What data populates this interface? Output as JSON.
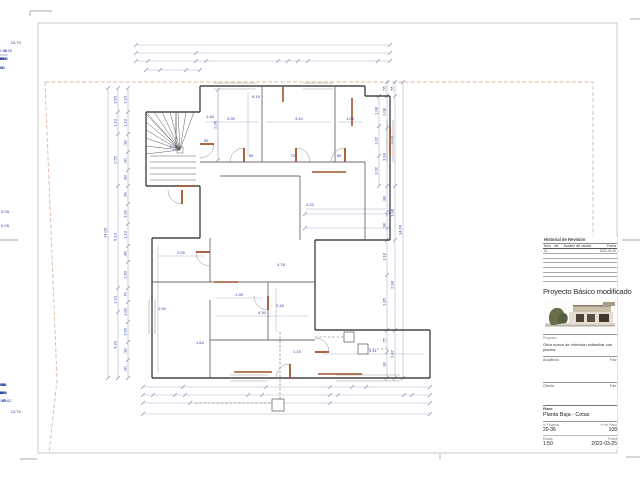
{
  "title_block": {
    "revision": {
      "title": "Historial de Revisión",
      "columns": [
        "Núm.",
        "Ind.",
        "Nombre del cambio",
        "Fecha"
      ],
      "rows": [
        [
          "01",
          "",
          "",
          "2022-03-25"
        ],
        [
          "",
          "",
          "",
          ""
        ],
        [
          "",
          "",
          "",
          ""
        ],
        [
          "",
          "",
          "",
          ""
        ],
        [
          "",
          "",
          "",
          ""
        ],
        [
          "",
          "",
          "",
          ""
        ],
        [
          "",
          "",
          "",
          ""
        ]
      ]
    },
    "project_title": "Proyecto Básico modificado",
    "project_label": "Proyecto:",
    "project_description": "Obra nueva de vivienda unifamiliar con piscina",
    "architect_label": "Arquitecto",
    "client_label": "Cliente",
    "signature_label": "Fdo:",
    "sheet_label": "Plano:",
    "sheet_name": "Planta Baja - Cotas",
    "project_no_label": "nº Proyecto",
    "project_no": "20-36",
    "plan_no_label": "nº de Plano",
    "plan_no": "108",
    "scale_label": "Escala",
    "scale": "1:50",
    "date_label": "Fecha",
    "date": "2022-03-25"
  },
  "colors": {
    "dim": "#aab2cf",
    "tick": "#8892bb",
    "dim_text": "#2b3e9e",
    "wall": "#474747",
    "interior": "#6b6b6b",
    "door": "#a0522d",
    "boundary": "#dcbaa4",
    "mark": "#a8a8a8",
    "border": "#c8c8c8",
    "window": "#9a9a9a",
    "utility": "#6a6a6a",
    "stair": "#5a5a5a"
  },
  "drawing": {
    "border": [
      38,
      23,
      579,
      430
    ],
    "marks": [
      [
        30,
        11,
        52,
        11
      ],
      [
        30,
        11,
        30,
        16
      ],
      [
        0,
        55,
        8,
        55
      ],
      [
        0,
        240,
        18,
        240
      ],
      [
        622,
        240,
        640,
        240
      ],
      [
        630,
        19,
        640,
        19
      ],
      [
        20,
        459,
        37,
        459
      ],
      [
        626,
        457,
        640,
        457
      ],
      [
        440,
        454,
        440,
        459
      ]
    ],
    "boundary": [
      "45,82 593,82 593,236",
      "45,82 57,380 49,453"
    ],
    "walls": [
      [
        200,
        86,
        365,
        86
      ],
      [
        365,
        86,
        365,
        96
      ],
      [
        365,
        96,
        390,
        96
      ],
      [
        390,
        96,
        390,
        240
      ],
      [
        390,
        240,
        315,
        240
      ],
      [
        315,
        240,
        315,
        330
      ],
      [
        315,
        330,
        430,
        330
      ],
      [
        430,
        330,
        430,
        378
      ],
      [
        430,
        378,
        152,
        378
      ],
      [
        152,
        378,
        152,
        238
      ],
      [
        152,
        238,
        200,
        238
      ],
      [
        200,
        238,
        200,
        186
      ],
      [
        200,
        186,
        146,
        186
      ],
      [
        146,
        186,
        146,
        112
      ],
      [
        146,
        112,
        200,
        112
      ],
      [
        200,
        112,
        200,
        86
      ]
    ],
    "interior": [
      [
        200,
        162,
        365,
        162
      ],
      [
        220,
        176,
        300,
        176
      ],
      [
        262,
        86,
        262,
        162
      ],
      [
        335,
        86,
        335,
        162
      ],
      [
        300,
        176,
        300,
        240
      ],
      [
        365,
        162,
        365,
        240
      ],
      [
        152,
        282,
        315,
        282
      ],
      [
        210,
        238,
        210,
        282
      ],
      [
        210,
        300,
        210,
        378
      ],
      [
        268,
        282,
        268,
        340
      ],
      [
        210,
        340,
        315,
        340
      ],
      [
        176,
        112,
        176,
        148
      ]
    ],
    "windows": [
      [
        214,
        83,
        256,
        83
      ],
      [
        214,
        89,
        256,
        89
      ],
      [
        303,
        83,
        333,
        83
      ],
      [
        303,
        89,
        333,
        89
      ],
      [
        387,
        120,
        387,
        162
      ],
      [
        393,
        120,
        393,
        162
      ],
      [
        149,
        300,
        149,
        334
      ],
      [
        155,
        300,
        155,
        334
      ],
      [
        230,
        375,
        268,
        375
      ],
      [
        230,
        381,
        268,
        381
      ],
      [
        336,
        375,
        400,
        375
      ],
      [
        336,
        381,
        400,
        381
      ]
    ],
    "orange": [
      [
        283,
        86,
        283,
        102
      ],
      [
        352,
        98,
        352,
        126
      ],
      [
        312,
        172,
        346,
        172
      ],
      [
        390,
        126,
        390,
        156
      ],
      [
        214,
        282,
        238,
        282
      ],
      [
        234,
        372,
        272,
        372
      ],
      [
        318,
        374,
        362,
        374
      ],
      [
        178,
        186,
        196,
        186
      ]
    ],
    "doors": [
      {
        "leaf": [
          244,
          162,
          244,
          148
        ],
        "arc": "M244,148 A14,14 0 0 0 230,162"
      },
      {
        "leaf": [
          296,
          162,
          296,
          148
        ],
        "arc": "M296,148 A14,14 0 0 1 310,162"
      },
      {
        "leaf": [
          345,
          162,
          345,
          148
        ],
        "arc": "M345,148 A14,14 0 0 0 331,162"
      },
      {
        "leaf": [
          200,
          144,
          214,
          144
        ],
        "arc": "M214,144 A14,14 0 0 1 200,158"
      },
      {
        "leaf": [
          210,
          252,
          196,
          252
        ],
        "arc": "M196,252 A14,14 0 0 0 210,266"
      },
      {
        "leaf": [
          268,
          296,
          268,
          310
        ],
        "arc": "M268,310 A14,14 0 0 1 254,296"
      },
      {
        "leaf": [
          290,
          378,
          290,
          364
        ],
        "arc": "M290,364 A14,14 0 0 0 276,378"
      },
      {
        "leaf": [
          315,
          352,
          329,
          352
        ],
        "arc": "M329,352 A14,14 0 0 0 315,338"
      },
      {
        "leaf": [
          182,
          190,
          182,
          204
        ],
        "arc": "M182,204 A14,14 0 0 1 168,190"
      }
    ],
    "stair": {
      "center": [
        180,
        150
      ],
      "targets": [
        [
          146,
          114
        ],
        [
          146,
          122
        ],
        [
          146,
          130
        ],
        [
          146,
          138
        ],
        [
          146,
          146
        ],
        [
          146,
          154
        ],
        [
          146,
          112
        ],
        [
          154,
          112
        ],
        [
          162,
          112
        ],
        [
          170,
          112
        ],
        [
          178,
          112
        ],
        [
          186,
          112
        ],
        [
          194,
          112
        ]
      ],
      "steps": [
        [
          150,
          156,
          196,
          156
        ],
        [
          150,
          162,
          196,
          162
        ],
        [
          150,
          168,
          196,
          168
        ],
        [
          150,
          174,
          196,
          174
        ],
        [
          150,
          180,
          196,
          180
        ]
      ]
    },
    "utility": {
      "dashes": [
        [
          280,
          332,
          280,
          401
        ],
        [
          195,
          403,
          274,
          403
        ],
        [
          315,
          337,
          344,
          337
        ],
        [
          368,
          349,
          388,
          349
        ]
      ],
      "squares": [
        [
          272,
          399,
          12,
          12
        ],
        [
          344,
          332,
          10,
          10
        ],
        [
          358,
          344,
          10,
          10
        ]
      ]
    },
    "aux": [
      [
        218,
        92,
        218,
        156
      ],
      [
        248,
        92,
        248,
        156
      ],
      [
        206,
        122,
        258,
        122
      ],
      [
        266,
        122,
        331,
        122
      ],
      [
        338,
        122,
        362,
        122
      ],
      [
        306,
        209,
        386,
        209
      ],
      [
        158,
        256,
        204,
        256
      ],
      [
        216,
        298,
        262,
        298
      ],
      [
        216,
        316,
        308,
        316
      ],
      [
        276,
        288,
        276,
        332
      ],
      [
        322,
        354,
        424,
        354
      ],
      [
        158,
        246,
        158,
        372
      ]
    ],
    "dims": [
      {
        "o": "h",
        "at": 45,
        "from": 136,
        "to": 390,
        "ticks": [
          136,
          390
        ],
        "labels": [
          [
            "15.73",
            268
          ]
        ]
      },
      {
        "o": "h",
        "at": 53,
        "from": 136,
        "to": 390,
        "ticks": [
          136,
          196,
          390
        ],
        "labels": [
          [
            "2.93",
            166
          ],
          [
            "8.20",
            296
          ]
        ]
      },
      {
        "o": "h",
        "at": 61,
        "from": 136,
        "to": 390,
        "ticks": [
          136,
          148,
          196,
          206,
          278,
          288,
          298,
          308,
          378,
          390
        ],
        "labels": [
          [
            ".90",
            142
          ],
          [
            "2.30",
            172
          ],
          [
            ".95",
            201
          ],
          [
            "3.10",
            242
          ],
          [
            ".75",
            283
          ],
          [
            ".80",
            293
          ],
          [
            ".73",
            303
          ],
          [
            "3.95",
            343
          ],
          [
            ".90",
            384
          ]
        ]
      },
      {
        "o": "h",
        "at": 70,
        "from": 146,
        "to": 200,
        "ticks": [
          146,
          160,
          186,
          200
        ],
        "labels": [
          [
            ".55",
            153
          ],
          [
            "1.40",
            173
          ],
          [
            ".55",
            193
          ]
        ]
      },
      {
        "o": "h",
        "at": 387,
        "from": 143,
        "to": 430,
        "ticks": [
          143,
          183,
          266,
          330,
          352,
          366,
          430
        ],
        "labels": [
          [
            "1.25",
            163
          ],
          [
            "2.20",
            224
          ],
          [
            "1.75",
            298
          ],
          [
            ".95",
            341
          ],
          [
            ".70",
            359
          ],
          [
            "2.60",
            398
          ]
        ]
      },
      {
        "o": "h",
        "at": 395,
        "from": 143,
        "to": 430,
        "ticks": [
          143,
          153,
          175,
          185,
          248,
          262,
          330,
          338,
          404,
          412,
          430
        ],
        "labels": [
          [
            ".35",
            148
          ],
          [
            ".80",
            164
          ],
          [
            ".35",
            180
          ],
          [
            "2.45",
            216
          ],
          [
            ".70",
            255
          ],
          [
            "2.90",
            296
          ],
          [
            ".25",
            334
          ],
          [
            "2.90",
            371
          ],
          [
            ".30",
            408
          ],
          [
            ".75",
            421
          ]
        ]
      },
      {
        "o": "h",
        "at": 403,
        "from": 143,
        "to": 430,
        "ticks": [
          143,
          190,
          330,
          430
        ],
        "labels": [
          [
            "1.55",
            166
          ],
          [
            "7.62",
            260
          ],
          [
            "2.40",
            380
          ]
        ]
      },
      {
        "o": "h",
        "at": 414,
        "from": 143,
        "to": 430,
        "ticks": [
          143,
          430
        ],
        "labels": [
          [
            "15.75",
            286
          ]
        ]
      },
      {
        "o": "v",
        "at": 108,
        "from": 88,
        "to": 378,
        "ticks": [
          88,
          378
        ],
        "labels": [
          [
            "14.00",
            233
          ]
        ]
      },
      {
        "o": "v",
        "at": 118,
        "from": 88,
        "to": 378,
        "ticks": [
          88,
          112,
          134,
          186,
          288,
          312,
          378
        ],
        "labels": [
          [
            "1.50",
            100
          ],
          [
            "1.10",
            123
          ],
          [
            "2.55",
            160
          ],
          [
            "5.10",
            237
          ],
          [
            "1.20",
            300
          ],
          [
            "3.30",
            345
          ]
        ]
      },
      {
        "o": "v",
        "at": 128,
        "from": 88,
        "to": 378,
        "ticks": [
          88,
          112,
          134,
          152,
          170,
          186,
          204,
          224,
          246,
          262,
          288,
          302,
          322,
          342,
          360,
          378
        ],
        "labels": [
          [
            "1.20",
            100
          ],
          [
            "1.10",
            123
          ],
          [
            ".90",
            143
          ],
          [
            ".90",
            161
          ],
          [
            ".80",
            178
          ],
          [
            ".90",
            195
          ],
          [
            "1.00",
            214
          ],
          [
            "1.10",
            235
          ],
          [
            ".80",
            254
          ],
          [
            "1.30",
            275
          ],
          [
            ".70",
            295
          ],
          [
            "1.00",
            312
          ],
          [
            "1.00",
            332
          ],
          [
            ".90",
            351
          ],
          [
            ".90",
            369
          ]
        ]
      },
      {
        "o": "v",
        "at": 403,
        "from": 82,
        "to": 378,
        "ticks": [
          82,
          378
        ],
        "labels": [
          [
            "14.60",
            230
          ]
        ]
      },
      {
        "o": "v",
        "at": 395,
        "from": 82,
        "to": 378,
        "ticks": [
          82,
          96,
          186,
          240,
          330,
          378
        ],
        "labels": [
          [
            ".55",
            89
          ],
          [
            "3.03",
            140
          ],
          [
            "1.98",
            213
          ],
          [
            "2.98",
            285
          ],
          [
            "1.47",
            354
          ]
        ]
      },
      {
        "o": "v",
        "at": 387,
        "from": 82,
        "to": 378,
        "ticks": [
          82,
          96,
          128,
          186,
          212,
          240,
          275,
          330,
          352,
          378
        ],
        "labels": [
          [
            ".55",
            89
          ],
          [
            "1.08",
            112
          ],
          [
            "1.93",
            157
          ],
          [
            ".88",
            199
          ],
          [
            ".98",
            226
          ],
          [
            "1.18",
            257
          ],
          [
            "1.85",
            302
          ],
          [
            ".75",
            341
          ],
          [
            ".90",
            365
          ]
        ]
      },
      {
        "o": "v",
        "at": 379,
        "from": 96,
        "to": 186,
        "ticks": [
          96,
          126,
          156,
          186
        ],
        "labels": [
          [
            "1.08",
            111
          ],
          [
            "1.02",
            141
          ],
          [
            "1.02",
            171
          ]
        ]
      },
      {
        "o": "v",
        "at": 218,
        "from": 90,
        "to": 160,
        "ticks": [
          90,
          160
        ],
        "labels": [
          [
            "2.06",
            125
          ]
        ]
      },
      {
        "o": "h",
        "at": 214,
        "from": 305,
        "to": 388,
        "ticks": [
          305,
          388
        ],
        "labels": [
          [
            "5.05",
            346
          ]
        ]
      },
      {
        "o": "h",
        "at": 228,
        "from": 305,
        "to": 388,
        "ticks": [
          305,
          388
        ],
        "labels": [
          [
            "5.05",
            346
          ]
        ]
      }
    ],
    "texts": [
      [
        "8.19",
        256,
        98
      ],
      [
        "2.90",
        231,
        120
      ],
      [
        "3.10",
        299,
        120
      ],
      [
        "1.05",
        350,
        120
      ],
      [
        "80",
        251,
        157
      ],
      [
        "72",
        293,
        157
      ],
      [
        "80",
        339,
        157
      ],
      [
        "90",
        206,
        142
      ],
      [
        "2.20",
        310,
        206
      ],
      [
        "2.05",
        181,
        254
      ],
      [
        "1.95",
        239,
        296
      ],
      [
        "4.30",
        262,
        314
      ],
      [
        "2.45",
        280,
        307
      ],
      [
        "4.78",
        281,
        266
      ],
      [
        "4.41",
        373,
        352
      ],
      [
        "1.15",
        297,
        353
      ],
      [
        "2.92",
        162,
        310
      ],
      [
        "1.64",
        200,
        344
      ],
      [
        "17.5",
        173,
        148
      ],
      [
        "1.40",
        210,
        118
      ]
    ]
  }
}
